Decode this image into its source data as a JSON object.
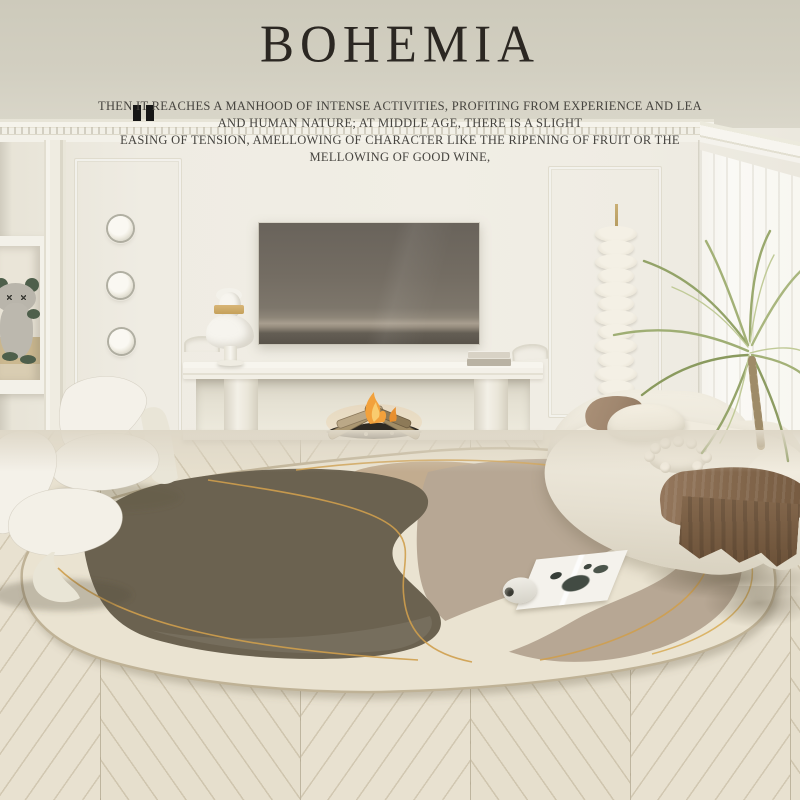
{
  "brand": {
    "title": "BOHEMIA"
  },
  "quote": {
    "icon": "pause-bars-icon",
    "line1": "THEN IT REACHES A MANHOOD OF INTENSE ACTIVITIES, PROFITING FROM EXPERIENCE AND LEA",
    "line2": "AND HUMAN NATURE; AT MIDDLE AGE, THERE IS A SLIGHT",
    "line3": "EASING OF TENSION, AMELLOWING OF CHARACTER LIKE THE RIPENING OF FRUIT OR THE",
    "line4": "MELLOWING OF GOOD WINE,"
  },
  "colors": {
    "ceiling": "#d2cfc1",
    "cornice": "#f3f1e9",
    "wall": "#efece3",
    "curtain": "#faf9f5",
    "tv-screen": "#746d63",
    "console": "#f3f0e8",
    "book": "#b9b2a3",
    "flame": "#f2a13c",
    "log": "#ab9771",
    "coals": "#2e2a23",
    "bust": "#f7f5ef",
    "bust-gold": "#c5a15a",
    "niche-tan": "#cbb88f",
    "toy-green": "#4e5f4b",
    "lamp": "#ece7da",
    "lamp-stem": "#b59b5f",
    "palm": "#a3b177",
    "trunk": "#b3a07c",
    "sofa": "#ebe6d9",
    "pillow-taupe": "#a0876f",
    "throw": "#84684d",
    "rug-base": "#eae3d1",
    "rug-dark": "#6b6250",
    "rug-tan": "#c2ac8f",
    "rug-greige": "#b7a794",
    "rug-gold": "#cf9f4c",
    "chair": "#f4f1e9",
    "magazine": "#f4f2ec",
    "magazine-print": "#2f3a31",
    "floor": "#e4dcca",
    "title-text": "#2b2722",
    "quote-text": "#45433e"
  }
}
